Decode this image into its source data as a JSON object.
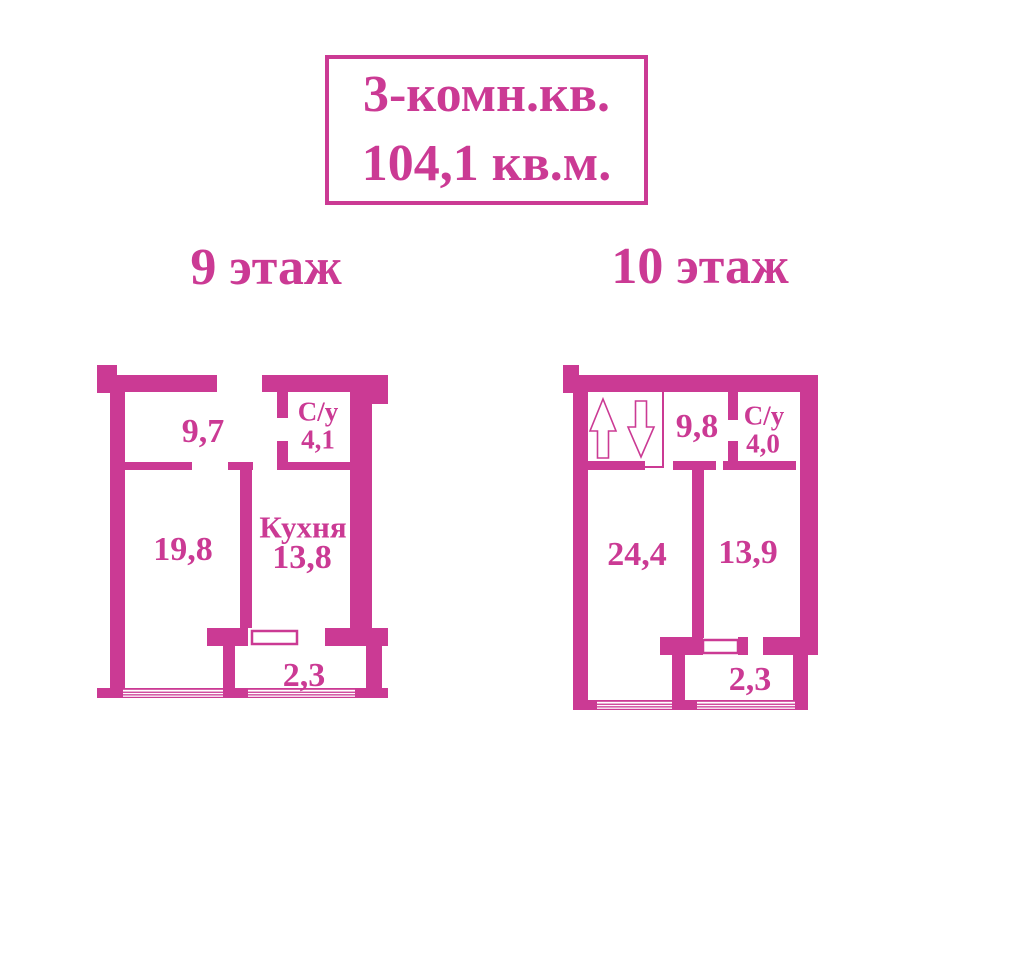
{
  "title": {
    "line1": "3-комн.кв.",
    "line2": "104,1 кв.м."
  },
  "colors": {
    "accent": "#cb3a94",
    "background": "#ffffff"
  },
  "floors": {
    "floor9": {
      "label": "9 этаж",
      "rooms": {
        "hallway": {
          "area": "9,7"
        },
        "bathroom": {
          "name": "С/у",
          "area": "4,1"
        },
        "living": {
          "area": "19,8"
        },
        "kitchen": {
          "name": "Кухня",
          "area": "13,8"
        },
        "balcony": {
          "area": "2,3"
        }
      }
    },
    "floor10": {
      "label": "10 этаж",
      "rooms": {
        "hallway": {
          "area": "9,8"
        },
        "bathroom": {
          "name": "С/у",
          "area": "4,0"
        },
        "living": {
          "area": "24,4"
        },
        "bedroom": {
          "area": "13,9"
        },
        "balcony": {
          "area": "2,3"
        }
      },
      "stairs_icons": [
        "up-arrow",
        "down-arrow"
      ]
    }
  }
}
